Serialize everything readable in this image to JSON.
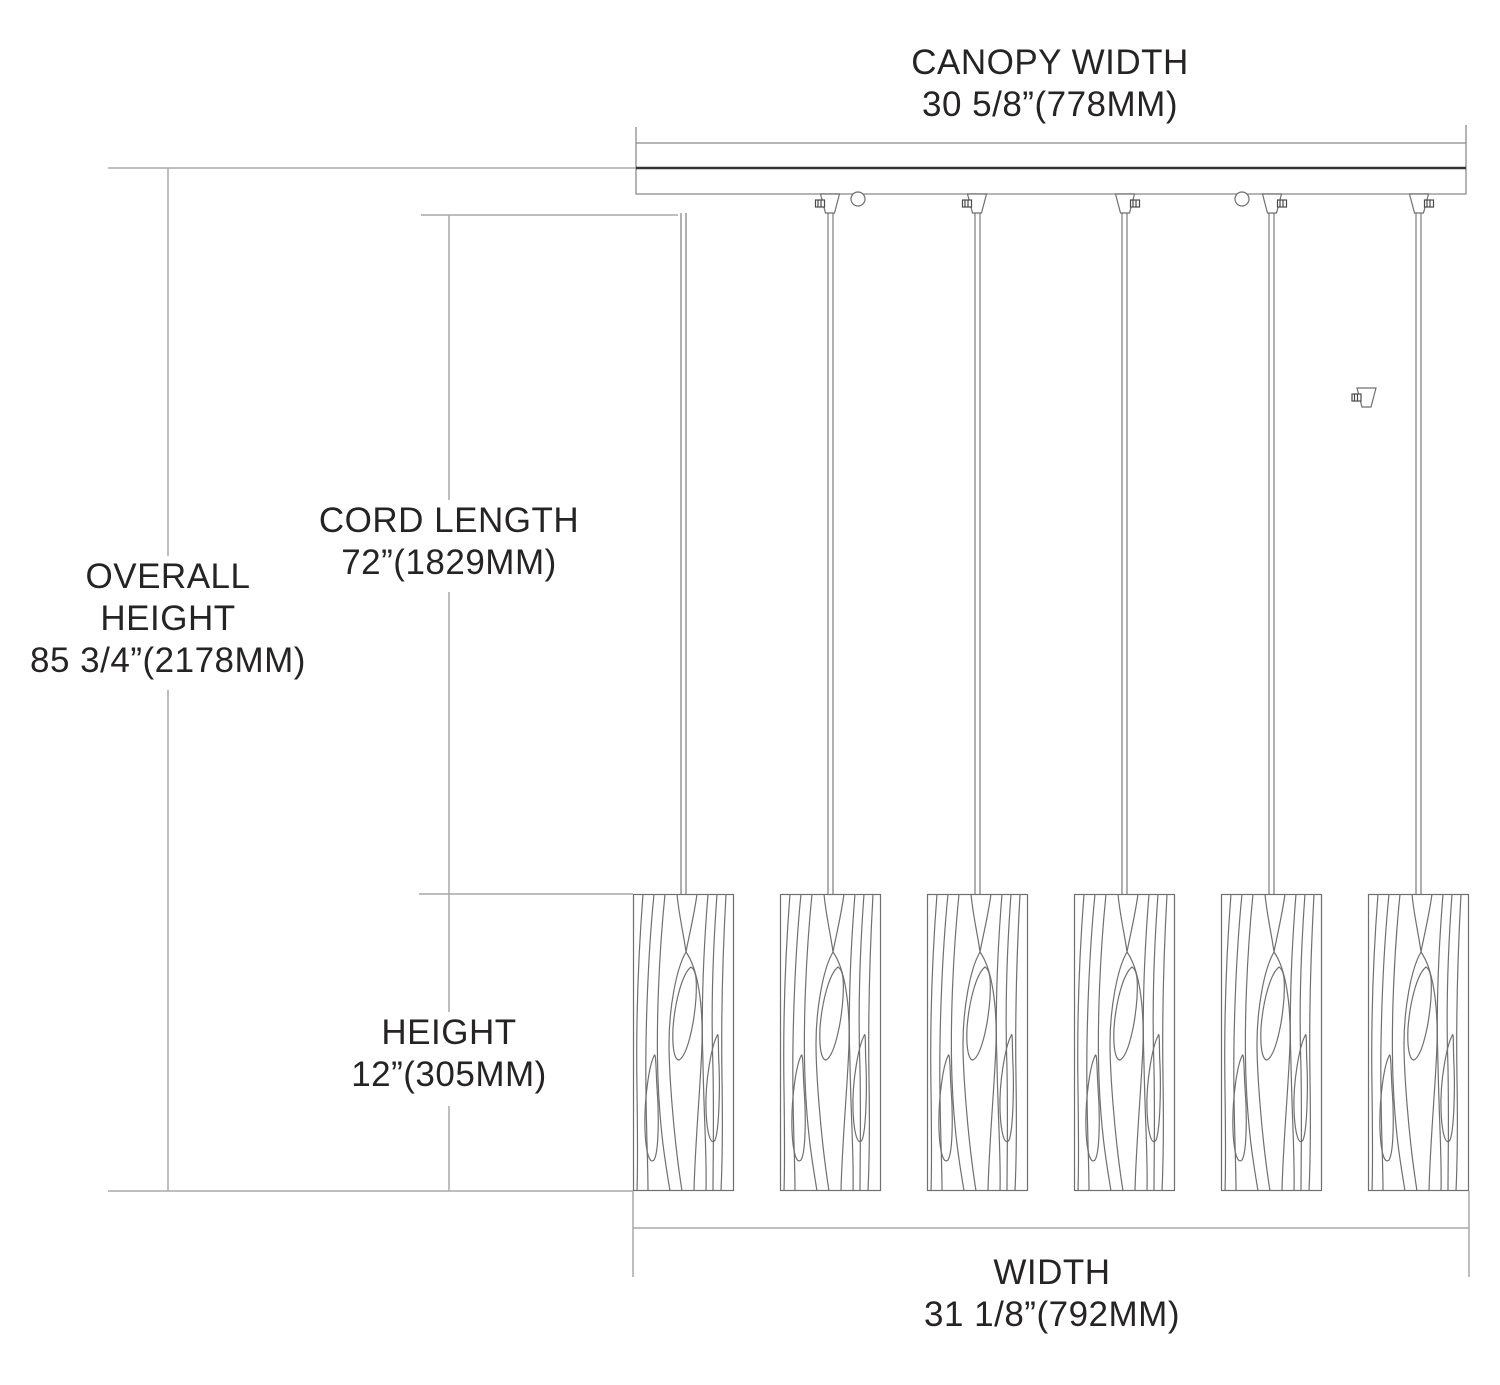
{
  "diagram": {
    "description": "6-light linear pendant fixture dimension drawing",
    "pendant_count": 6,
    "labels": {
      "canopy_width": {
        "title": "CANOPY WIDTH",
        "value": "30 5/8”(778MM)"
      },
      "cord_length": {
        "title": "CORD LENGTH",
        "value": "72”(1829MM)"
      },
      "overall_height": {
        "title_line1": "OVERALL",
        "title_line2": "HEIGHT",
        "value": "85 3/4”(2178MM)"
      },
      "shade_height": {
        "title": "HEIGHT",
        "value": "12”(305MM)"
      },
      "width": {
        "title": "WIDTH",
        "value": "31 1/8”(792MM)"
      }
    },
    "colors": {
      "background": "#ffffff",
      "text": "#262324",
      "dimension_line": "#a9a9a9",
      "fixture_line": "#6f6f6f",
      "canopy_accent": "#333333"
    }
  }
}
